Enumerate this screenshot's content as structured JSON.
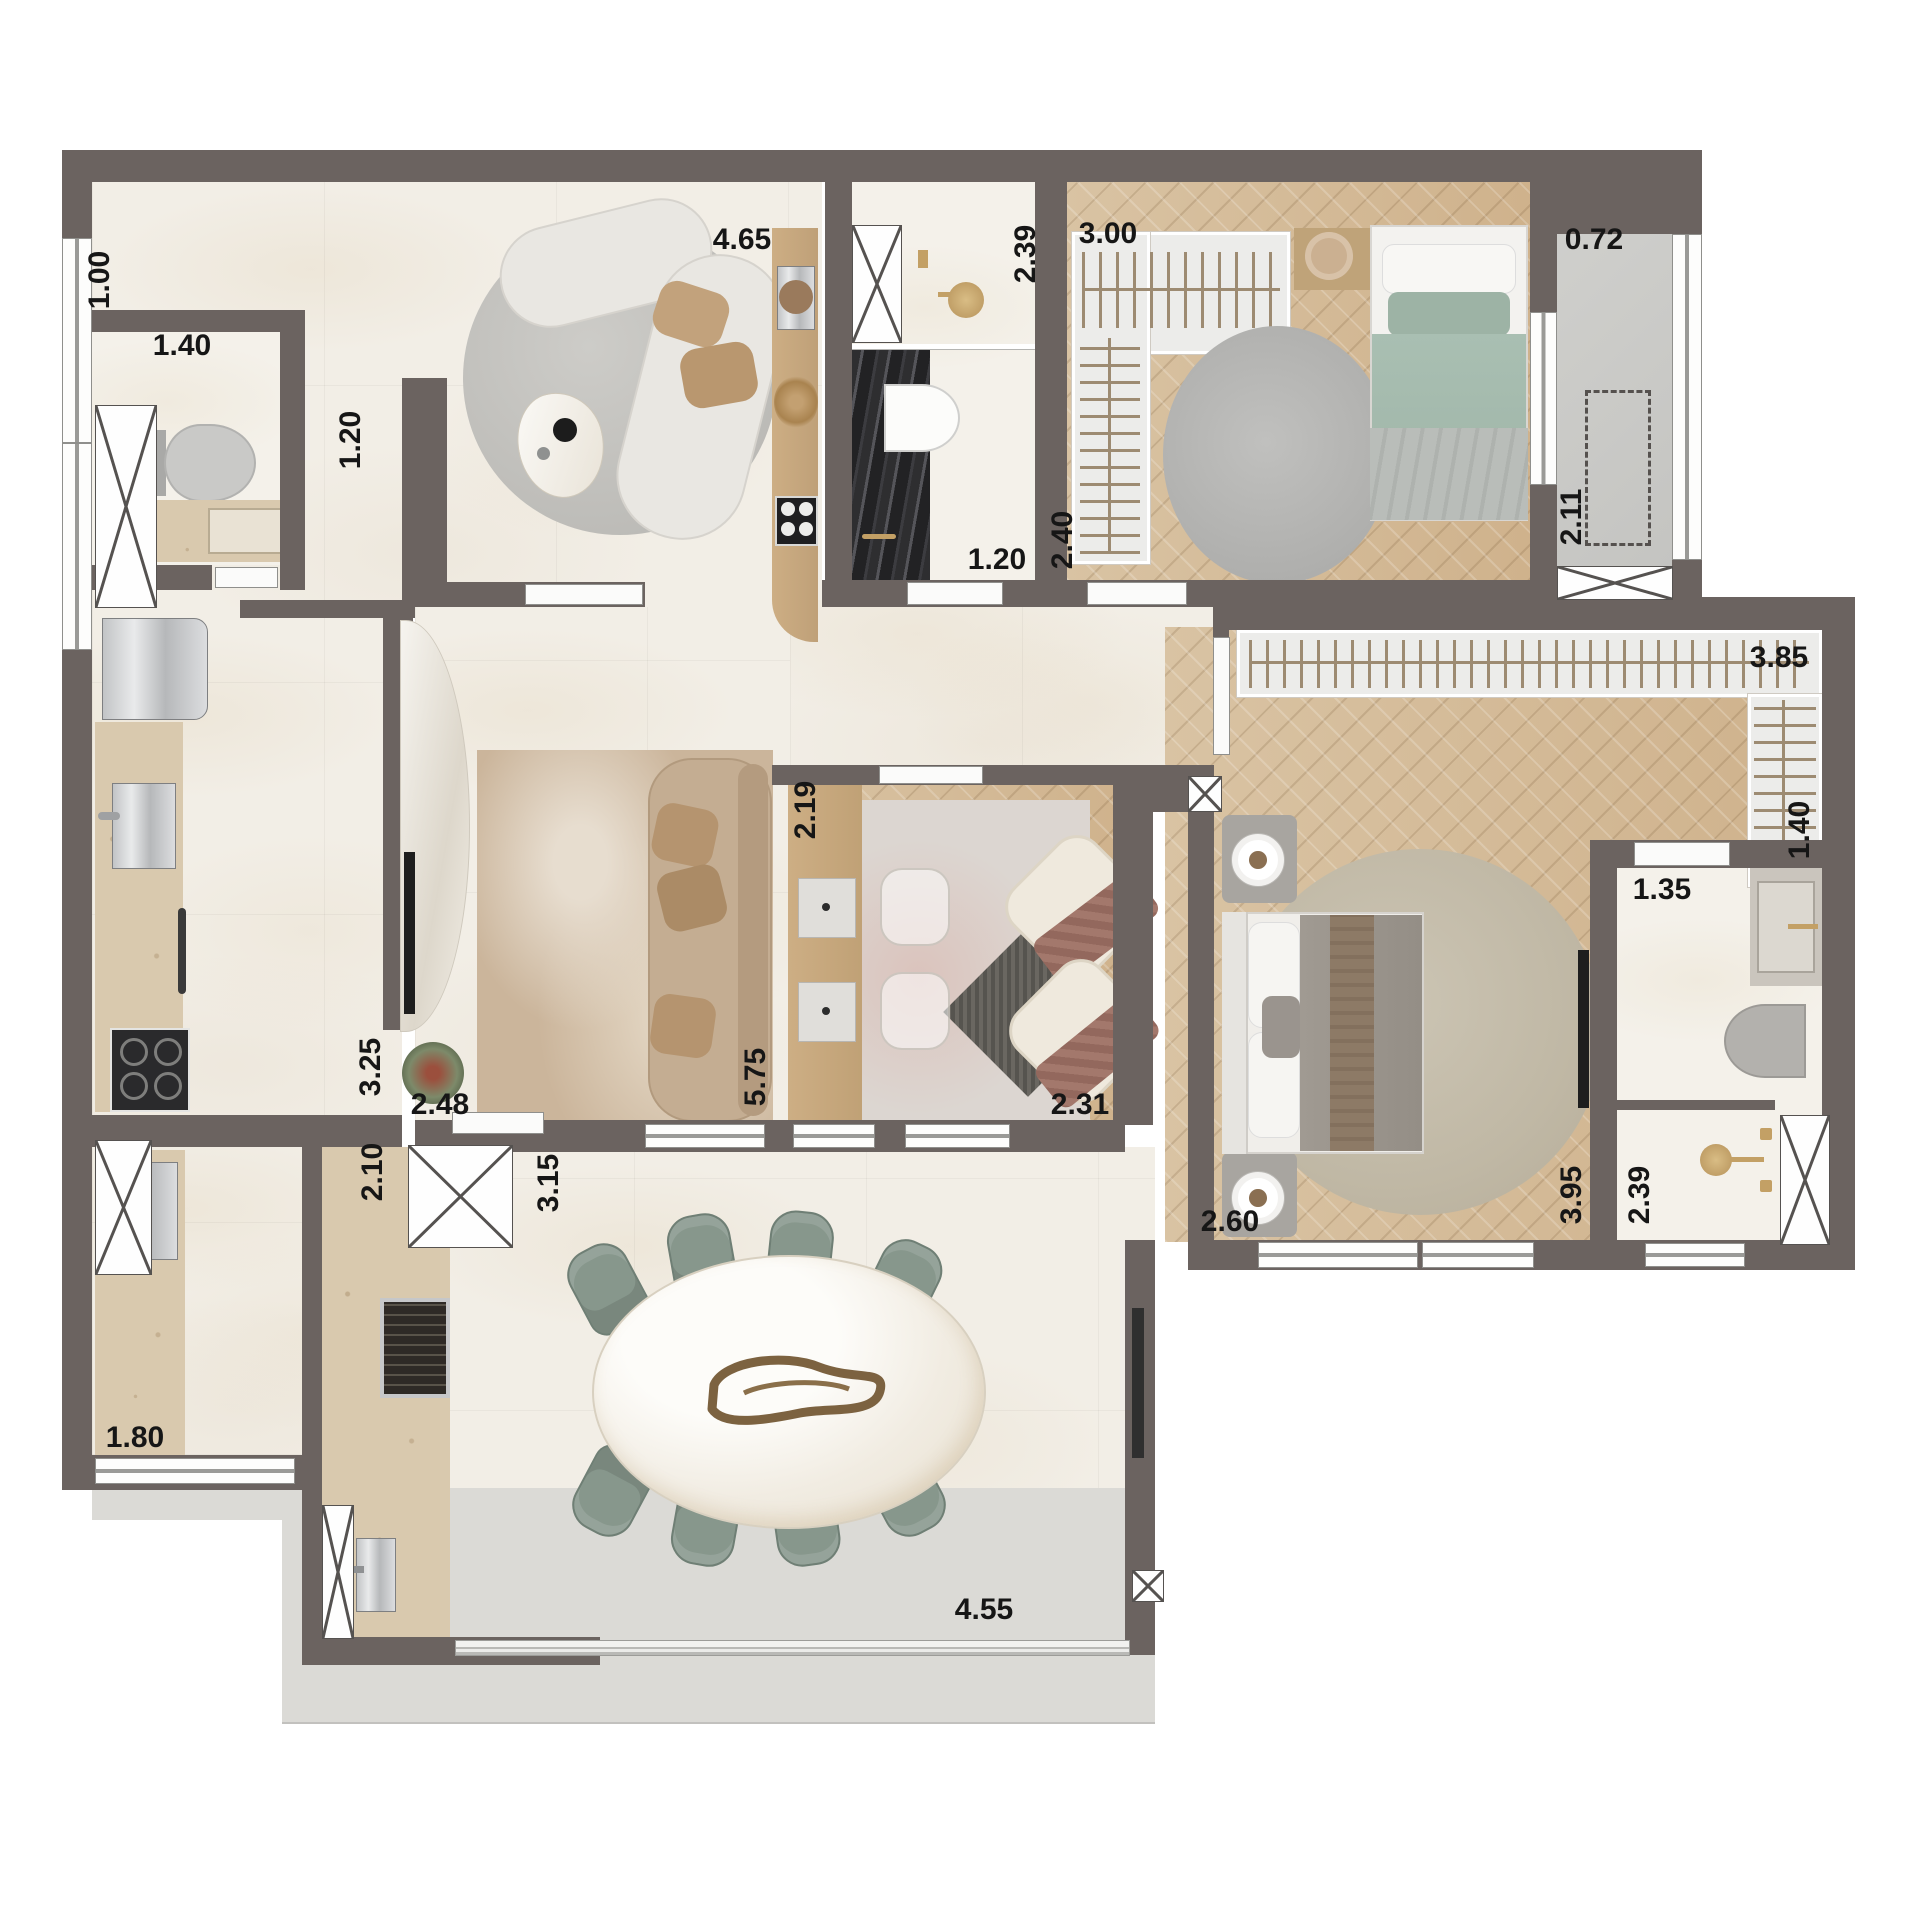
{
  "plan": {
    "type": "apartment-floor-plan-top-view",
    "palette": {
      "wall": "#6b6360",
      "marble_floor": "#f2eee6",
      "wood_floor": "#cfb28c",
      "closet": "#ececea",
      "counter_stone": "#d9c9ae",
      "black_marble": "#2a2a2c",
      "terrace": "#dbdad6",
      "balcony_concrete": "#cbcbc8",
      "chair_green": "#87978c",
      "sofa_beige": "#c4ad92",
      "gold_fixture": "#c3a065",
      "label_text": "#161616"
    },
    "labels": [
      {
        "text": "1.00"
      },
      {
        "text": "4.65"
      },
      {
        "text": "2.39"
      },
      {
        "text": "3.00"
      },
      {
        "text": "0.72"
      },
      {
        "text": "1.40"
      },
      {
        "text": "1.20"
      },
      {
        "text": "1.20"
      },
      {
        "text": "2.40"
      },
      {
        "text": "2.11"
      },
      {
        "text": "3.85"
      },
      {
        "text": "1.40"
      },
      {
        "text": "2.19"
      },
      {
        "text": "1.35"
      },
      {
        "text": "3.25"
      },
      {
        "text": "2.48"
      },
      {
        "text": "5.75"
      },
      {
        "text": "2.31"
      },
      {
        "text": "2.10"
      },
      {
        "text": "3.15"
      },
      {
        "text": "2.60"
      },
      {
        "text": "3.95"
      },
      {
        "text": "2.39"
      },
      {
        "text": "1.80"
      },
      {
        "text": "4.55"
      }
    ]
  }
}
